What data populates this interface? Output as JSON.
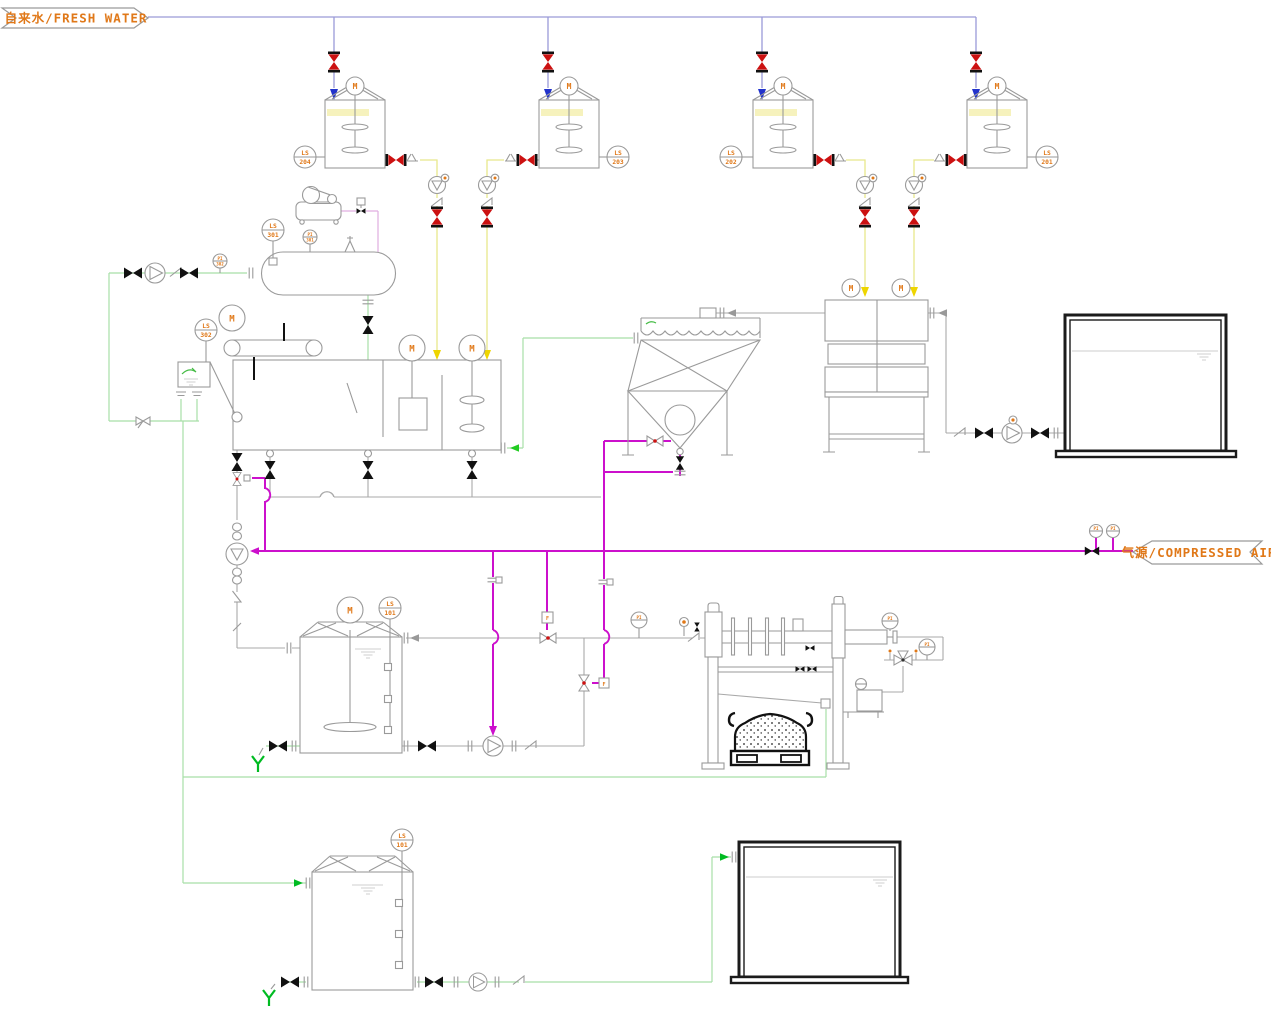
{
  "banners": {
    "fresh_water": "自来水/FRESH WATER",
    "compressed_air": "气源/COMPRESSED AIR"
  },
  "labels": {
    "motor": "M",
    "pi": "PI",
    "f": "F",
    "ls204": [
      "LS",
      "204"
    ],
    "ls203": [
      "LS",
      "203"
    ],
    "ls202": [
      "LS",
      "202"
    ],
    "ls201": [
      "LS",
      "201"
    ],
    "ls301": [
      "LS",
      "301"
    ],
    "ls302": [
      "LS",
      "302"
    ],
    "ls101": [
      "LS",
      "101"
    ],
    "pi301": [
      "PI",
      "301"
    ],
    "pi302": [
      "PI",
      "302"
    ]
  },
  "colors": {
    "accent_orange": "#e07818",
    "fresh_water_line": "#9a9ad8",
    "chemical_line": "#e8e88c",
    "water_line": "#a8dfa8",
    "bright_green": "#00bb22",
    "air_line": "#cc10cc",
    "compressor_line": "#e0aee0",
    "valve_red": "#cc1111",
    "equipment_gray": "#9a9a9a"
  }
}
